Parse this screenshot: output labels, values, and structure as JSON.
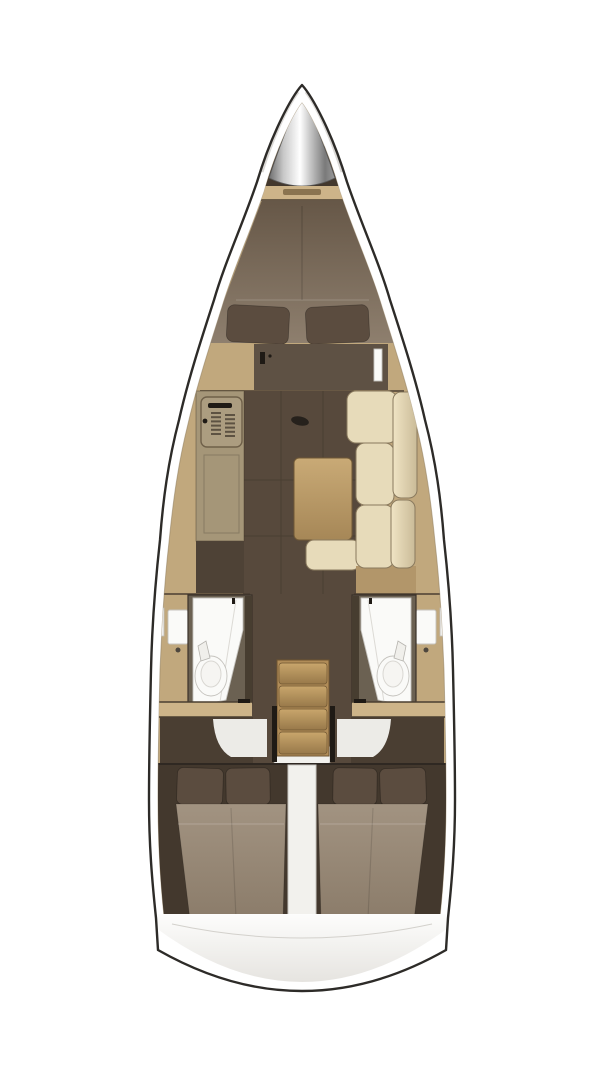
{
  "canvas": {
    "width": 604,
    "height": 1080
  },
  "palette": {
    "background": "#ffffff",
    "hull_outline": "#2d2b28",
    "deck_white": "#ffffff",
    "deck_shadow": "#d7d5d1",
    "wood_light": "#c1a87d",
    "wood_band": "#cdb489",
    "wood_mid": "#b2966a",
    "stair_wood": "#b08c58",
    "table_light": "#c9aa76",
    "table_dark": "#a68757",
    "galley_counter": "#a59678",
    "galley_cabinet": "#4e4236",
    "floor_dark": "#57493c",
    "panel_dark": "#5e5144",
    "cabin_dark": "#43382d",
    "entry_dark": "#4a3e32",
    "bed_fore_dark": "#665747",
    "bed_fore_light": "#8e7f6e",
    "mattress_light": "#a29381",
    "mattress_dark": "#8b7c6a",
    "pillow_dark": "#5b4c3f",
    "cushion_beige": "#e7dbba",
    "cushion_edge": "#8a7a5e",
    "cushion_hi": "#f0e4c4",
    "cushion_lo": "#cabb98",
    "head_wall": "#6b6152",
    "door_dark": "#473d30",
    "fixture_white": "#fafaf8",
    "fixture_outline": "#c5c3be",
    "engine_white": "#f2f1ed",
    "engine_edge": "#c8c6c1",
    "metal_dark": "#6e6e6e",
    "metal_mid": "#c8c8c8",
    "metal_light": "#ffffff",
    "transom_top": "#fdfdfc",
    "transom_bottom": "#e6e4e0",
    "seam_dark": "#4a3e31"
  }
}
